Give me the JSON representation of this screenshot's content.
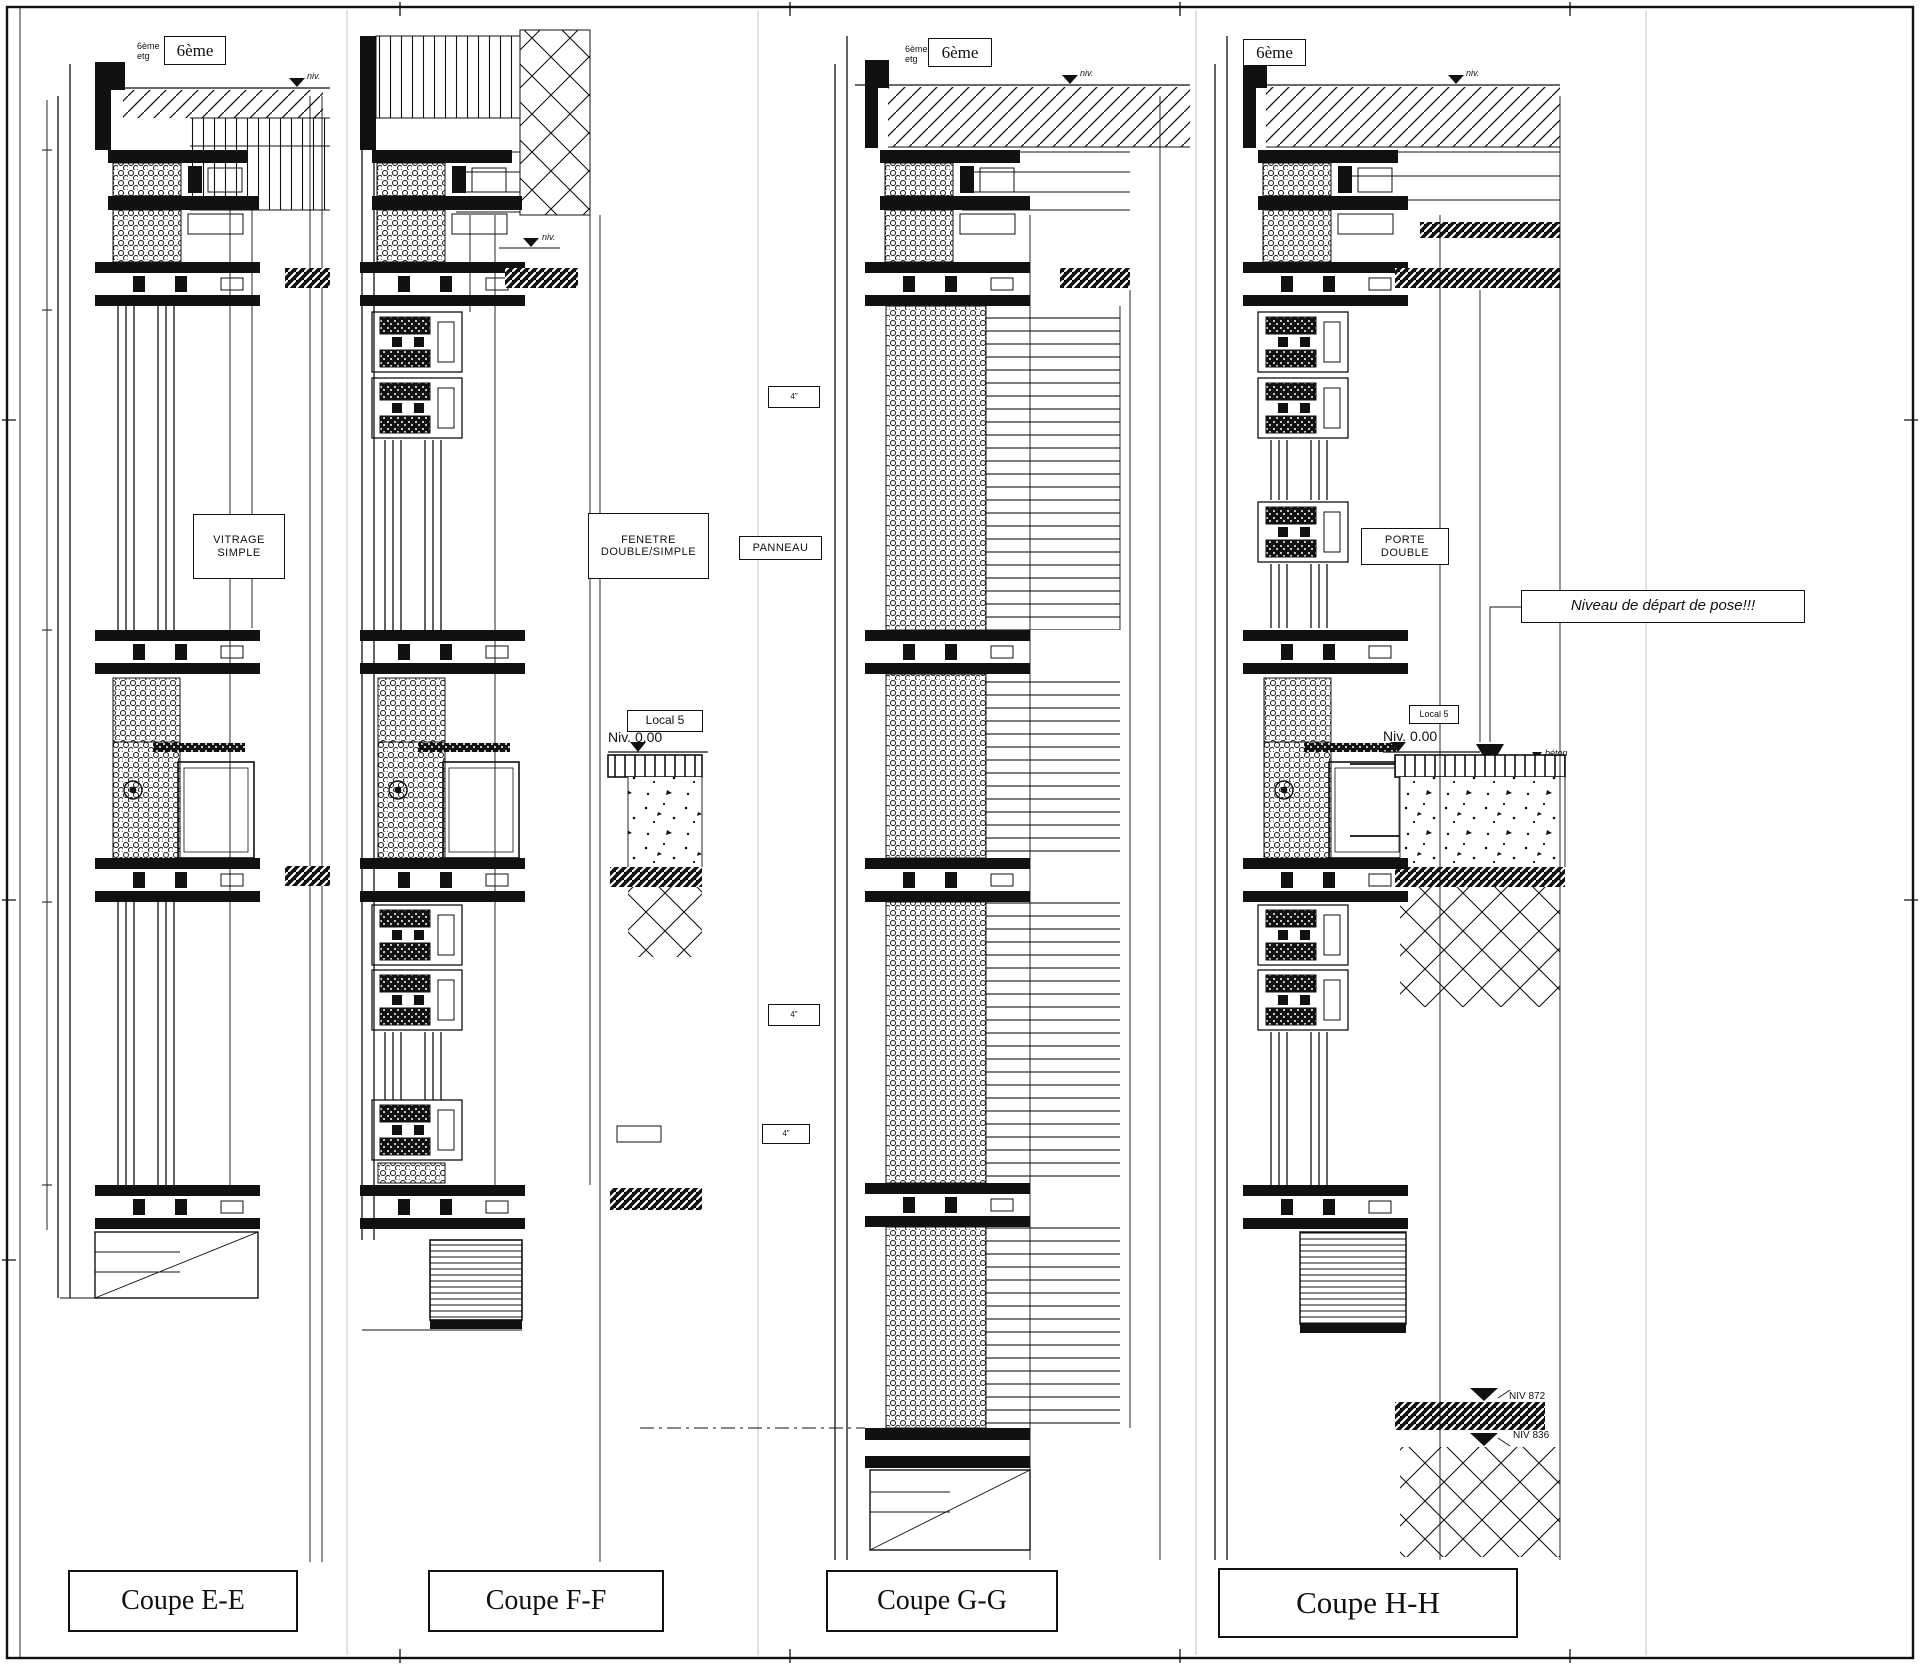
{
  "sheet": {
    "background": "#ffffff",
    "ink": "#111111",
    "floor_tag": "6ème",
    "floor_small": "6ème\netg",
    "niv_small": "niv.",
    "beton": "béton",
    "detail_mark": "4\"",
    "sections": [
      {
        "title": "Coupe E-E",
        "component": "VITRAGE\nSIMPLE"
      },
      {
        "title": "Coupe F-F",
        "component": "FENETRE\nDOUBLE/SIMPLE",
        "room": "Local 5",
        "level": "Niv. 0.00"
      },
      {
        "title": "Coupe G-G",
        "component": "PANNEAU"
      },
      {
        "title": "Coupe H-H",
        "component": "PORTE\nDOUBLE",
        "room": "Local 5",
        "level": "Niv. 0.00",
        "annotation": "Niveau de départ de pose!!!",
        "niv_upper": "NIV 872",
        "niv_lower": "NIV 836"
      }
    ]
  }
}
